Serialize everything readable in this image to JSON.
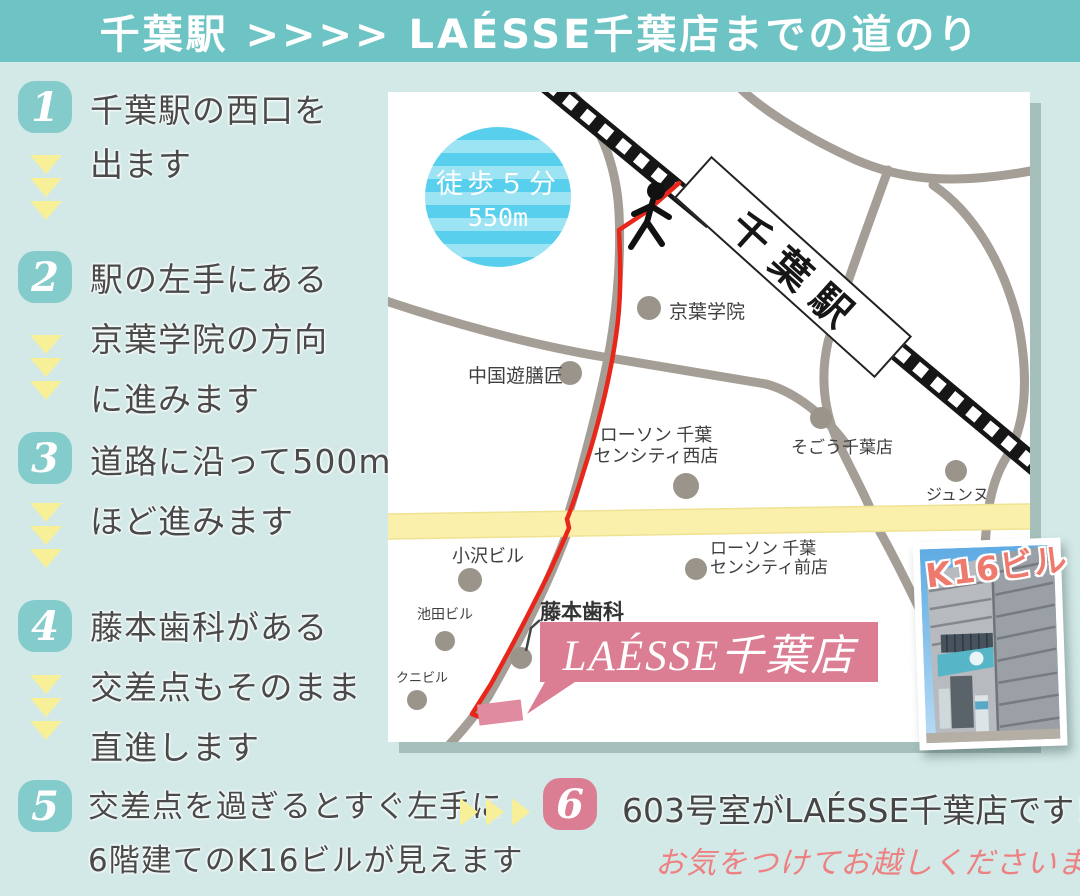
{
  "header": {
    "title": "千葉駅 >>>> LAÉSSE千葉店までの道のり"
  },
  "steps": [
    {
      "number": "1",
      "lines": [
        "千葉駅の西口を",
        "出ます"
      ]
    },
    {
      "number": "2",
      "lines": [
        "駅の左手にある",
        "京葉学院の方向",
        "に進みます"
      ]
    },
    {
      "number": "3",
      "lines": [
        "道路に沿って500m",
        "ほど進みます"
      ]
    },
    {
      "number": "4",
      "lines": [
        "藤本歯科がある",
        "交差点もそのまま",
        "直進します"
      ]
    },
    {
      "number": "5",
      "lines": [
        "交差点を過ぎるとすぐ左手に",
        "6階建てのK16ビルが見えます"
      ]
    },
    {
      "number": "6",
      "lines": [
        "603号室がLAÉSSE千葉店です！"
      ],
      "note": "お気をつけてお越しくださいませ"
    }
  ],
  "map": {
    "station_label": "千葉駅",
    "walk_badge": {
      "time": "徒歩５分",
      "distance": "550m"
    },
    "destination_label": "LAÉSSE千葉店",
    "dental_label": "藤本歯科",
    "photo_label": "K16ビル",
    "labels": [
      {
        "lines": [
          "京葉学院"
        ]
      },
      {
        "lines": [
          "中国遊膳匠"
        ]
      },
      {
        "lines": [
          "ローソン 千葉",
          "センシティ西店"
        ]
      },
      {
        "lines": [
          "そごう千葉店"
        ]
      },
      {
        "lines": [
          "ジュンヌ"
        ]
      },
      {
        "lines": [
          "ローソン 千葉",
          "センシティ前店"
        ]
      },
      {
        "lines": [
          "小沢ビル"
        ]
      },
      {
        "lines": [
          "池田ビル"
        ]
      },
      {
        "lines": [
          "クニビル"
        ]
      }
    ]
  },
  "icons": {
    "walker": "walking-person-icon",
    "railway": "railway-track",
    "down_arrow": "triangle-down-icon",
    "right_arrow": "triangle-right-icon",
    "landmark": "landmark-dot-icon"
  },
  "colors": {
    "header_teal": "#6ec4c4",
    "background_mint": "#d2e9e7",
    "step_badge_teal": "#84cbcb",
    "arrow_yellow": "#f8f098",
    "route_red": "#e8261a",
    "road_gray": "#a49e96",
    "main_street_yellow": "#faf0ac",
    "brand_pink": "#dc7e93",
    "caution_pink": "#ed8080",
    "walk_badge_blue": "#59cfee",
    "text_dark": "#4a4a4a"
  }
}
